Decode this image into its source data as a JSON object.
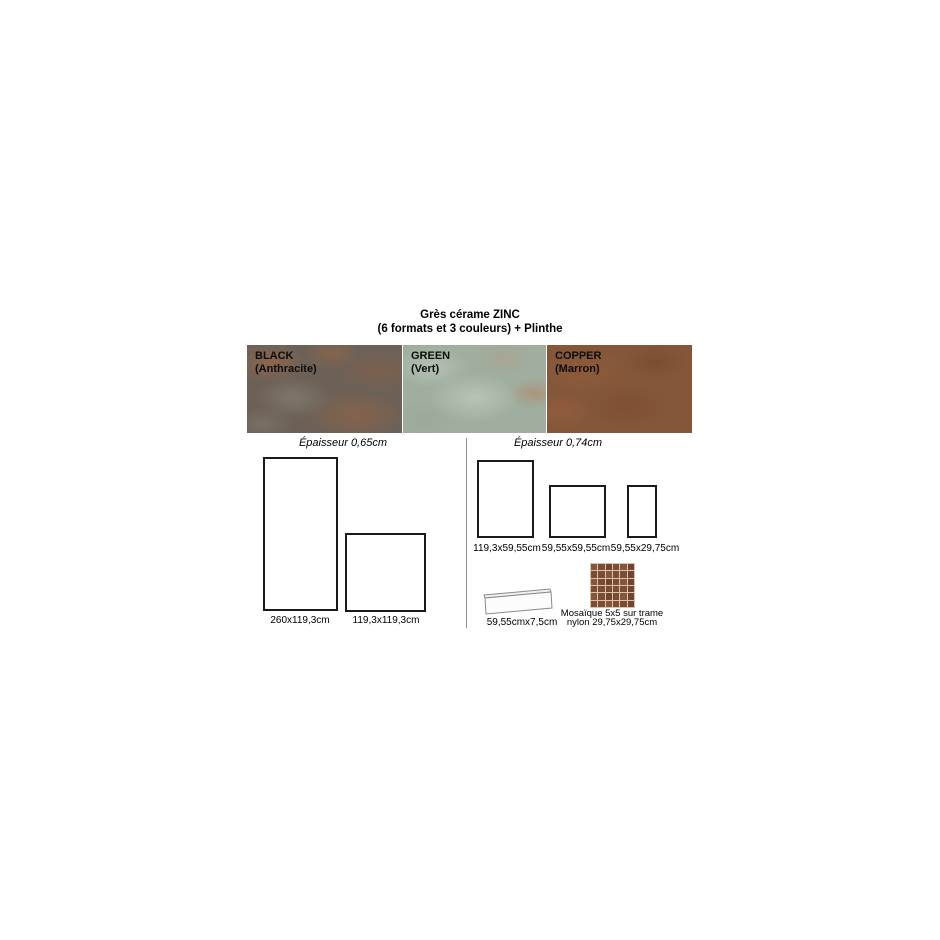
{
  "title": {
    "line1": "Grès cérame ZINC",
    "line2": "(6 formats et 3 couleurs) + Plinthe"
  },
  "swatches": [
    {
      "name": "BLACK",
      "subtitle": "(Anthracite)",
      "color": "#6d6157"
    },
    {
      "name": "GREEN",
      "subtitle": "(Vert)",
      "color": "#9fae9f"
    },
    {
      "name": "COPPER",
      "subtitle": "(Marron)",
      "color": "#85573a"
    }
  ],
  "sections": {
    "left": {
      "thickness_label": "Épaisseur 0,65cm",
      "formats": [
        {
          "label": "260x119,3cm"
        },
        {
          "label": "119,3x119,3cm"
        }
      ]
    },
    "right": {
      "thickness_label": "Épaisseur 0,74cm",
      "formats": [
        {
          "label": "119,3x59,55cm"
        },
        {
          "label": "59,55x59,55cm"
        },
        {
          "label": "59,55x29,75cm"
        }
      ],
      "plinthe": {
        "label": "59,55cmx7,5cm"
      },
      "mosaic": {
        "label_line1": "Mosaïque 5x5 sur trame",
        "label_line2": "nylon 29,75x29,75cm",
        "rows": 6,
        "cols": 6,
        "tile_color": "#7c4c34",
        "grout_color": "#d9c2aa"
      }
    }
  },
  "colors": {
    "background": "#ffffff",
    "text": "#000000",
    "rect_border": "#1a1a1a",
    "divider": "#8f8f8f"
  }
}
